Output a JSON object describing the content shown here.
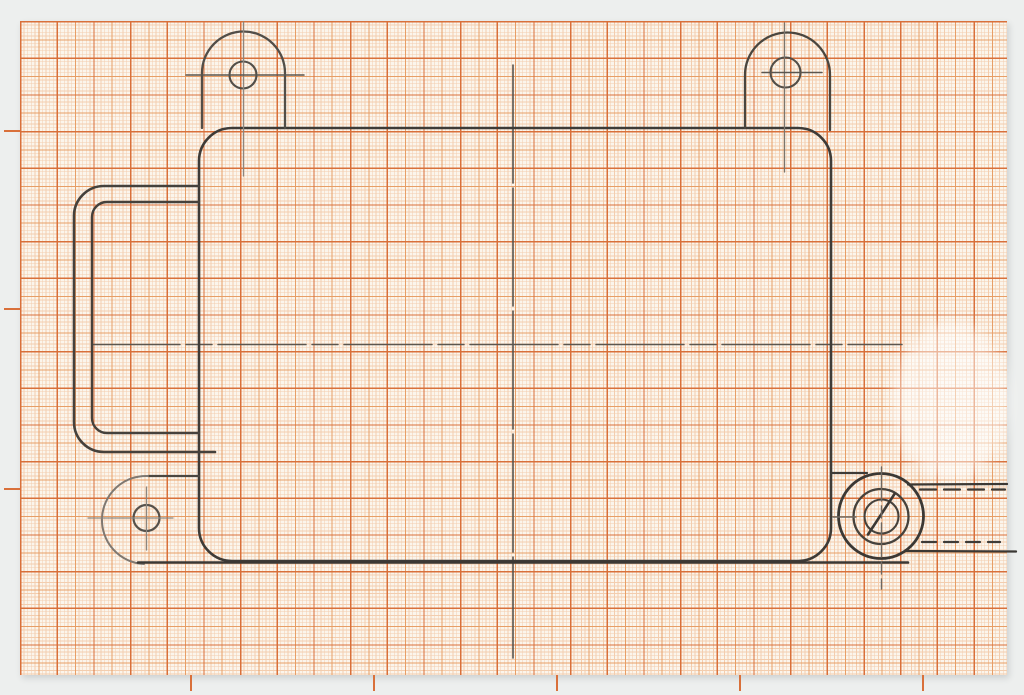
{
  "scan": {
    "background_color": "#edefee",
    "paper": {
      "x": 20,
      "y": 21,
      "width": 987,
      "height": 654,
      "base_color": "#fbf5ec",
      "grid": {
        "fine_spacing": 3.667,
        "medium_spacing": 18.335,
        "heavy_spacing": 36.67,
        "fine_color": "#f3cdae",
        "medium_color": "#e79e66",
        "heavy_color": "#d9703a",
        "fine_width": 0.7,
        "medium_width": 1.0,
        "heavy_width": 1.35
      },
      "edge_ticks": {
        "left_y": [
          130,
          308,
          488
        ],
        "bottom_x": [
          190,
          373,
          556,
          739,
          922
        ],
        "length": 16,
        "thickness": 1.6,
        "color": "#d9703a"
      },
      "eraser_smudge": {
        "x": 892,
        "y": 322,
        "width": 118,
        "height": 158
      }
    },
    "pencil_colors": {
      "dark": "#3b3834",
      "medium": "#56514b",
      "light": "#8d867e"
    },
    "drawing": {
      "description_name": "pencil-technical-drawing",
      "shapes": [
        {
          "name": "main-vertical-centerline",
          "type": "line",
          "x1": 513,
          "y1": 65,
          "x2": 513,
          "y2": 658,
          "stroke": "#57534d",
          "sw": 1.6,
          "dash": "118 5"
        },
        {
          "name": "main-horizontal-centerline",
          "type": "line",
          "x1": 92,
          "y1": 344.5,
          "x2": 902,
          "y2": 344.5,
          "stroke": "#5b564f",
          "sw": 1.5,
          "dash": "88 6 26 6"
        },
        {
          "name": "main-body-outline",
          "type": "rect",
          "x": 199,
          "y": 128,
          "w": 632,
          "h": 433,
          "rx": 33,
          "stroke": "#3e3b37",
          "sw": 2.6
        },
        {
          "name": "handle-outer-outline",
          "type": "path",
          "d": "M 199,186 L 104,186 A 30,30 0 0 0 74,216 L 74,422 A 30,30 0 0 0 104,452 L 215,452",
          "stroke": "#45413c",
          "sw": 2.6
        },
        {
          "name": "handle-inner-outline",
          "type": "path",
          "d": "M 199,202 L 107,202 A 15,15 0 0 0 92,217 L 92,418 A 15,15 0 0 0 107,433 L 199,433",
          "stroke": "#45413c",
          "sw": 2.4
        },
        {
          "name": "tab-top-left-outline",
          "type": "path",
          "d": "M 202,128 L 202,73 A 41.5,41.5 0 0 1 285,73 L 285,128",
          "stroke": "#524e48",
          "sw": 2.3
        },
        {
          "name": "tab-top-left-hole",
          "type": "circle",
          "cx": 243,
          "cy": 75,
          "r": 13.5,
          "stroke": "#524e48",
          "sw": 2.1
        },
        {
          "name": "tab-top-left-v-centerline",
          "type": "line",
          "x1": 243.5,
          "y1": 22,
          "x2": 243.5,
          "y2": 176,
          "stroke": "#8d867e",
          "sw": 1.3
        },
        {
          "name": "tab-top-left-h-centerline",
          "type": "line",
          "x1": 186,
          "y1": 75,
          "x2": 304,
          "y2": 75,
          "stroke": "#5b564f",
          "sw": 1.5
        },
        {
          "name": "tab-top-right-outline",
          "type": "path",
          "d": "M 745,128 L 745,75 A 42.5,42.5 0 0 1 830,75 L 830,130",
          "stroke": "#4a463f",
          "sw": 2.3
        },
        {
          "name": "tab-top-right-hole",
          "type": "circle",
          "cx": 785.5,
          "cy": 72.5,
          "r": 15,
          "stroke": "#524e48",
          "sw": 2.1
        },
        {
          "name": "tab-top-right-v-centerline",
          "type": "line",
          "x1": 784.5,
          "y1": 23,
          "x2": 784.5,
          "y2": 172,
          "stroke": "#7b756d",
          "sw": 1.3
        },
        {
          "name": "tab-top-right-h-centerline",
          "type": "line",
          "x1": 762,
          "y1": 72.5,
          "x2": 822,
          "y2": 72.5,
          "stroke": "#5b564f",
          "sw": 1.5
        },
        {
          "name": "tab-bottom-left-top-edge",
          "type": "line",
          "x1": 199,
          "y1": 476,
          "x2": 148,
          "y2": 476,
          "stroke": "#4a4640",
          "sw": 2.2
        },
        {
          "name": "tab-bottom-left-arc",
          "type": "path",
          "d": "M 148,476 A 44,44 0 0 0 144,564",
          "stroke": "#7f7871",
          "sw": 2
        },
        {
          "name": "tab-bottom-left-hole",
          "type": "circle",
          "cx": 146.5,
          "cy": 518,
          "r": 13,
          "stroke": "#56514b",
          "sw": 2.2
        },
        {
          "name": "tab-bottom-left-h-centerline",
          "type": "line",
          "x1": 88,
          "y1": 518,
          "x2": 173,
          "y2": 518,
          "stroke": "#8d867e",
          "sw": 1.3
        },
        {
          "name": "tab-bottom-left-v-centerline",
          "type": "line",
          "x1": 146.5,
          "y1": 487,
          "x2": 146.5,
          "y2": 550,
          "stroke": "#8d867e",
          "sw": 1.3
        },
        {
          "name": "base-line",
          "type": "line",
          "x1": 138,
          "y1": 562.5,
          "x2": 908,
          "y2": 562.5,
          "stroke": "#3b3834",
          "sw": 2.6
        },
        {
          "name": "boss-step-line",
          "type": "line",
          "x1": 831,
          "y1": 473,
          "x2": 867,
          "y2": 473,
          "stroke": "#3e3b37",
          "sw": 2.2
        },
        {
          "name": "screw-boss-circle",
          "type": "circle",
          "cx": 881,
          "cy": 516,
          "r": 42.5,
          "stroke": "#3b3834",
          "sw": 2.8
        },
        {
          "name": "screw-head-circle",
          "type": "circle",
          "cx": 881,
          "cy": 516.5,
          "r": 27.5,
          "stroke": "#46423c",
          "sw": 2.3
        },
        {
          "name": "screw-shank-circle",
          "type": "circle",
          "cx": 881.5,
          "cy": 516.5,
          "r": 17,
          "stroke": "#46423c",
          "sw": 2.1
        },
        {
          "name": "screw-slot-line",
          "type": "line",
          "x1": 894.5,
          "y1": 494,
          "x2": 868,
          "y2": 534.5,
          "stroke": "#3b3834",
          "sw": 2.6
        },
        {
          "name": "boss-side-top-line",
          "type": "line",
          "x1": 908,
          "y1": 484.5,
          "x2": 1007,
          "y2": 484,
          "stroke": "#3b3834",
          "sw": 2.3
        },
        {
          "name": "boss-side-bottom-line",
          "type": "line",
          "x1": 906,
          "y1": 551,
          "x2": 1016,
          "y2": 551.5,
          "stroke": "#3b3834",
          "sw": 2.3
        },
        {
          "name": "hidden-thread-top-line",
          "type": "line",
          "x1": 920,
          "y1": 489.5,
          "x2": 1005,
          "y2": 489.5,
          "stroke": "#3e3b37",
          "sw": 2.2,
          "dash": "16 8"
        },
        {
          "name": "hidden-thread-bottom-line",
          "type": "line",
          "x1": 922,
          "y1": 542,
          "x2": 1000,
          "y2": 542,
          "stroke": "#3e3b37",
          "sw": 2.2,
          "dash": "14 8"
        },
        {
          "name": "screw-v-centerline",
          "type": "line",
          "x1": 881.5,
          "y1": 467,
          "x2": 881.5,
          "y2": 589,
          "stroke": "#6e6861",
          "sw": 1.4,
          "dash": "34 5 12 5"
        },
        {
          "name": "screw-h-centerline",
          "type": "line",
          "x1": 833,
          "y1": 517,
          "x2": 856,
          "y2": 517,
          "stroke": "#6e6861",
          "sw": 1.4
        }
      ]
    }
  }
}
